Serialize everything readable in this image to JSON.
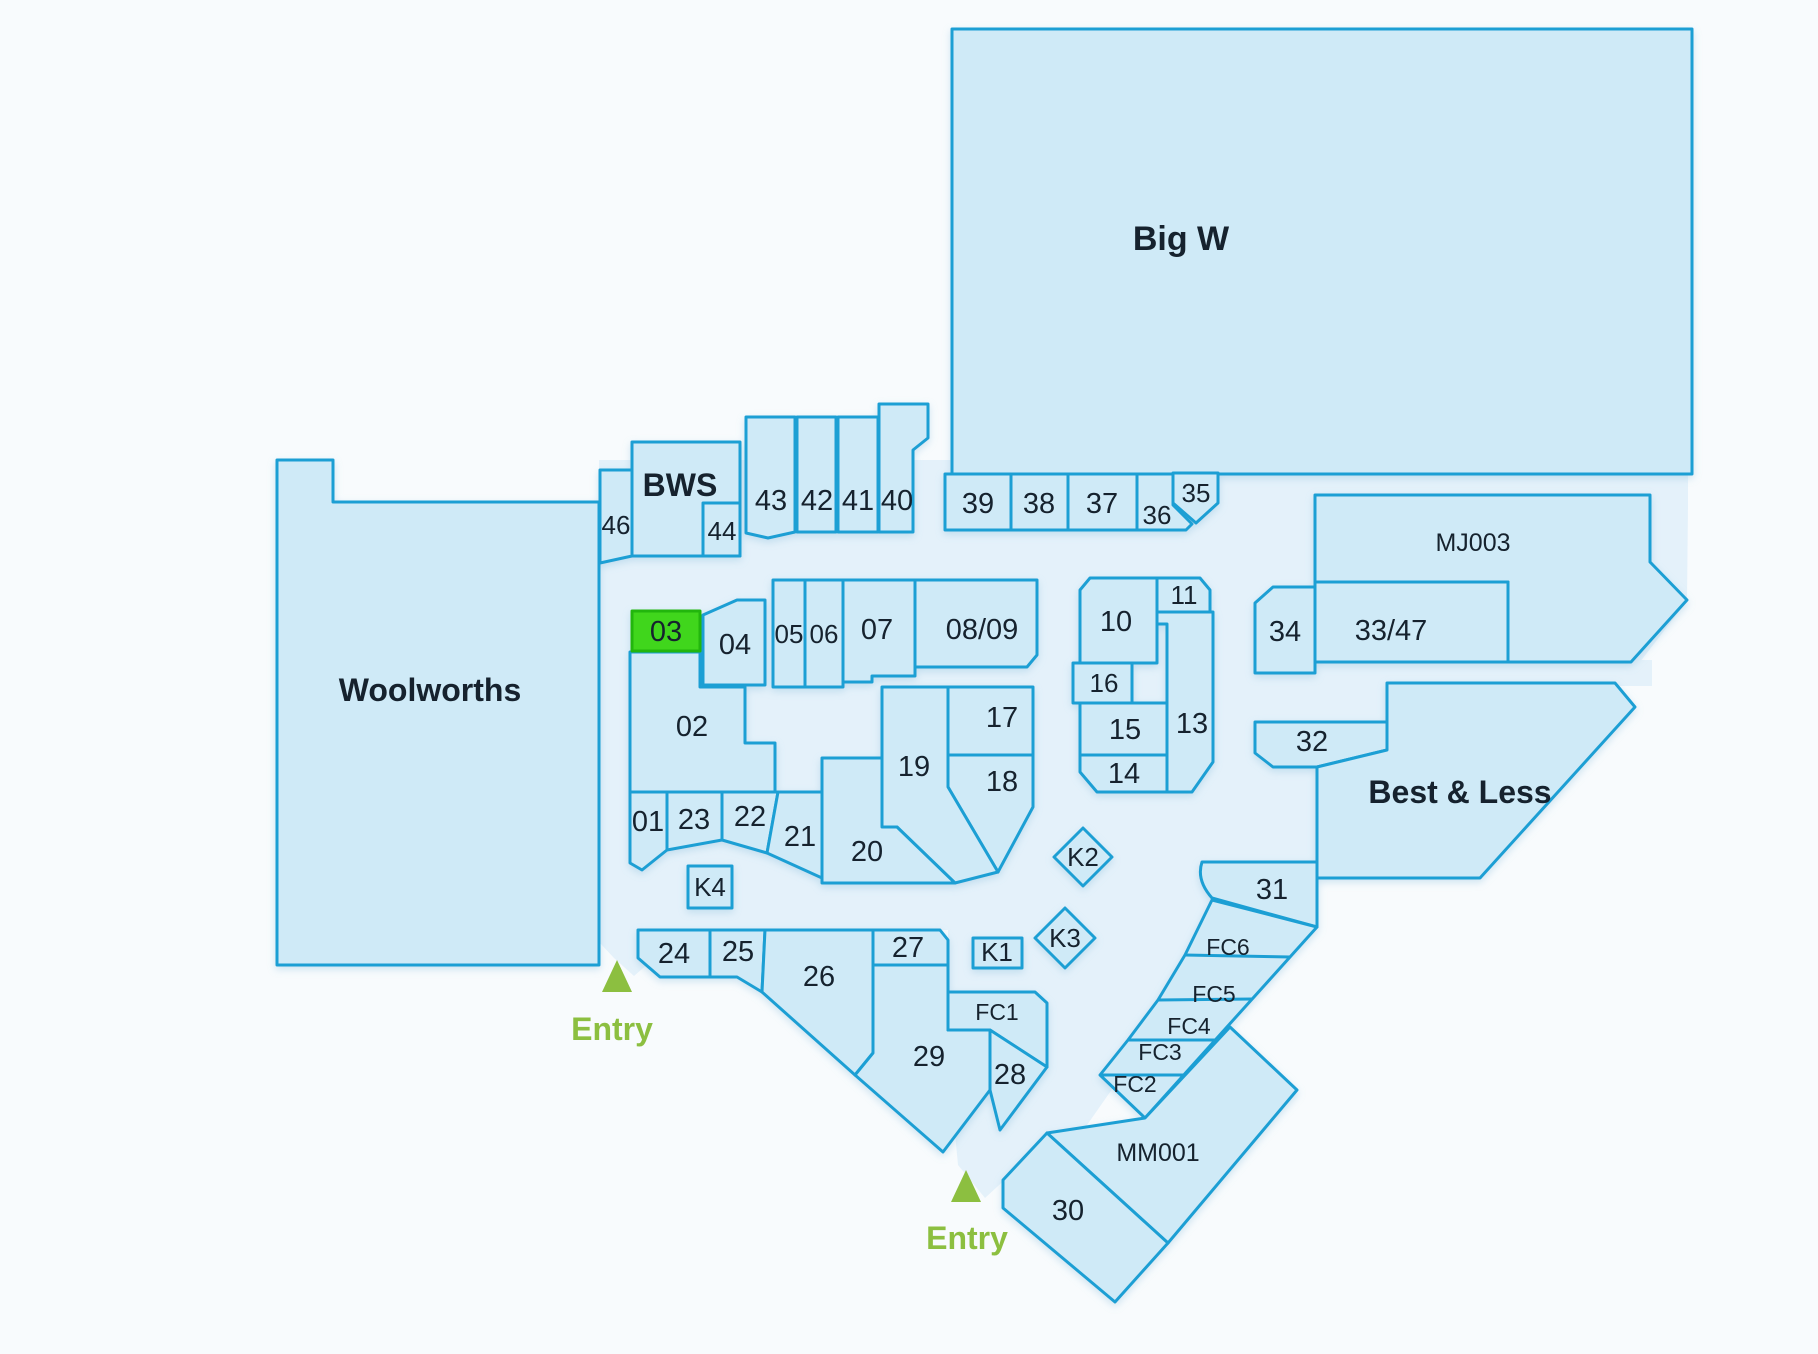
{
  "map": {
    "highlighted_shop": "03",
    "colors": {
      "page_background": "#f8fbfd",
      "walkway": "#e4f1fa",
      "shop_fill": "#cfeaf7",
      "outline_blue": "#1f9fd4",
      "highlight_fill": "#3fd61f",
      "highlight_outline": "#23b60d",
      "label_text": "#14232e",
      "entry_green": "#8cbf40"
    }
  },
  "labels": {
    "bigw": "Big W",
    "woolworths": "Woolworths",
    "bws": "BWS",
    "bestless": "Best & Less",
    "mj003": "MJ003",
    "mm001": "MM001",
    "s01": "01",
    "s02": "02",
    "s03": "03",
    "s04": "04",
    "s05": "05",
    "s06": "06",
    "s07": "07",
    "s0809": "08/09",
    "s10": "10",
    "s11": "11",
    "s13": "13",
    "s14": "14",
    "s15": "15",
    "s16": "16",
    "s17": "17",
    "s18": "18",
    "s19": "19",
    "s20": "20",
    "s21": "21",
    "s22": "22",
    "s23": "23",
    "s24": "24",
    "s25": "25",
    "s26": "26",
    "s27": "27",
    "s28": "28",
    "s29": "29",
    "s30": "30",
    "s31": "31",
    "s32": "32",
    "s3347": "33/47",
    "s34": "34",
    "s35": "35",
    "s36": "36",
    "s37": "37",
    "s38": "38",
    "s39": "39",
    "s40": "40",
    "s41": "41",
    "s42": "42",
    "s43": "43",
    "s44": "44",
    "s46": "46",
    "k1": "K1",
    "k2": "K2",
    "k3": "K3",
    "k4": "K4",
    "fc1": "FC1",
    "fc2": "FC2",
    "fc3": "FC3",
    "fc4": "FC4",
    "fc5": "FC5",
    "fc6": "FC6",
    "entry": "Entry"
  }
}
